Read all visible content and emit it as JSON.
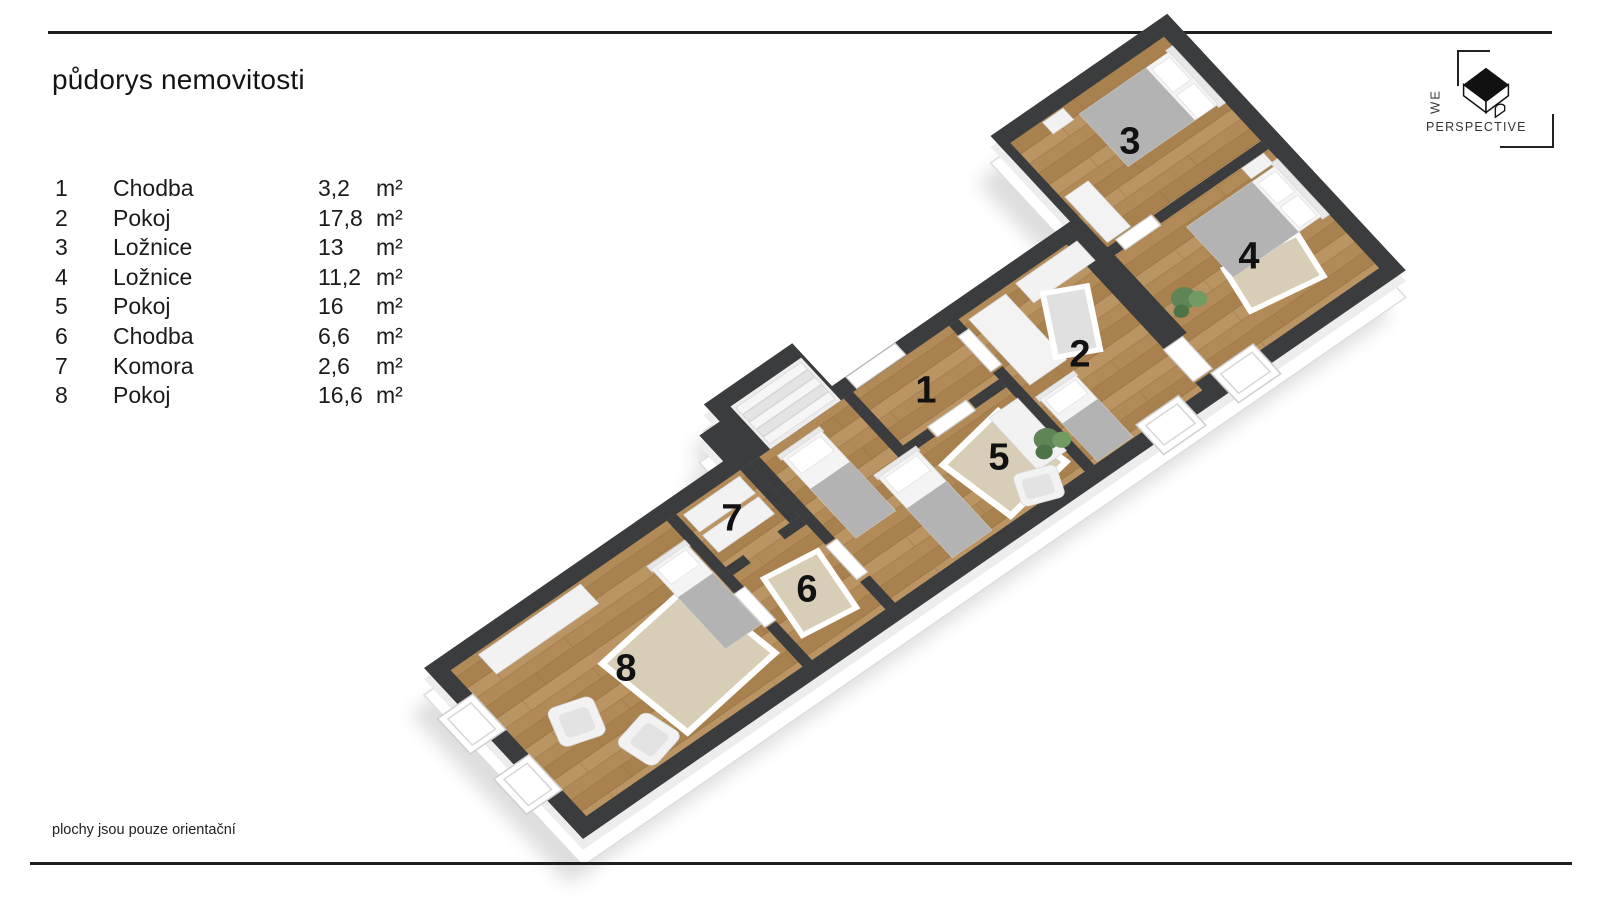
{
  "title": "půdorys nemovitosti",
  "footer": "plochy jsou pouze orientační",
  "logo": {
    "we": "WE",
    "perspective": "PERSPECTIVE"
  },
  "legend": {
    "rows": [
      {
        "num": "1",
        "name": "Chodba",
        "area": "3,2",
        "unit": "m²"
      },
      {
        "num": "2",
        "name": "Pokoj",
        "area": "17,8",
        "unit": "m²"
      },
      {
        "num": "3",
        "name": "Ložnice",
        "area": "13",
        "unit": "m²"
      },
      {
        "num": "4",
        "name": "Ložnice",
        "area": "11,2",
        "unit": "m²"
      },
      {
        "num": "5",
        "name": "Pokoj",
        "area": "16",
        "unit": "m²"
      },
      {
        "num": "6",
        "name": "Chodba",
        "area": "6,6",
        "unit": "m²"
      },
      {
        "num": "7",
        "name": "Komora",
        "area": "2,6",
        "unit": "m²"
      },
      {
        "num": "8",
        "name": "Pokoj",
        "area": "16,6",
        "unit": "m²"
      }
    ]
  },
  "plan": {
    "labels": [
      "1",
      "2",
      "3",
      "4",
      "5",
      "6",
      "7",
      "8"
    ],
    "colors": {
      "wall_top": "#3a3c3e",
      "wall_face": "#ffffff",
      "floor_wood": "#b28a58",
      "rug": "#d8cdb6",
      "furniture": "#f2f2f2",
      "blanket": "#b3b3b3",
      "plant": "#5f8456",
      "label_text": "#111111",
      "rule": "#1e1e1e"
    }
  }
}
